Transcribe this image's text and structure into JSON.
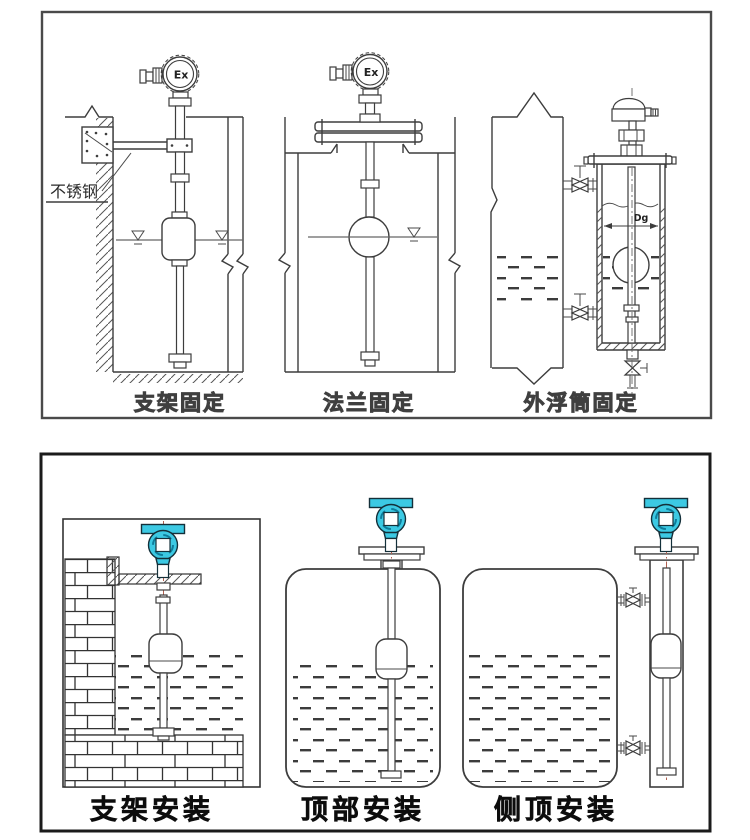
{
  "colors": {
    "line": "#3d3d3d",
    "accent_cyan": "#3cc9e3",
    "centerline_red": "#b06050",
    "panel_border_top": "#4a4a4a",
    "panel_border_bottom": "#1b1b1b"
  },
  "top_panel": {
    "ex_label": "Ex",
    "dg_label": "Dg",
    "stainless_label": "不锈钢",
    "captions": {
      "left": "支架固定",
      "middle": "法兰固定",
      "right": "外浮筒固定"
    }
  },
  "bottom_panel": {
    "captions": {
      "left": "支架安装",
      "middle": "顶部安装",
      "right": "侧顶安装"
    }
  }
}
